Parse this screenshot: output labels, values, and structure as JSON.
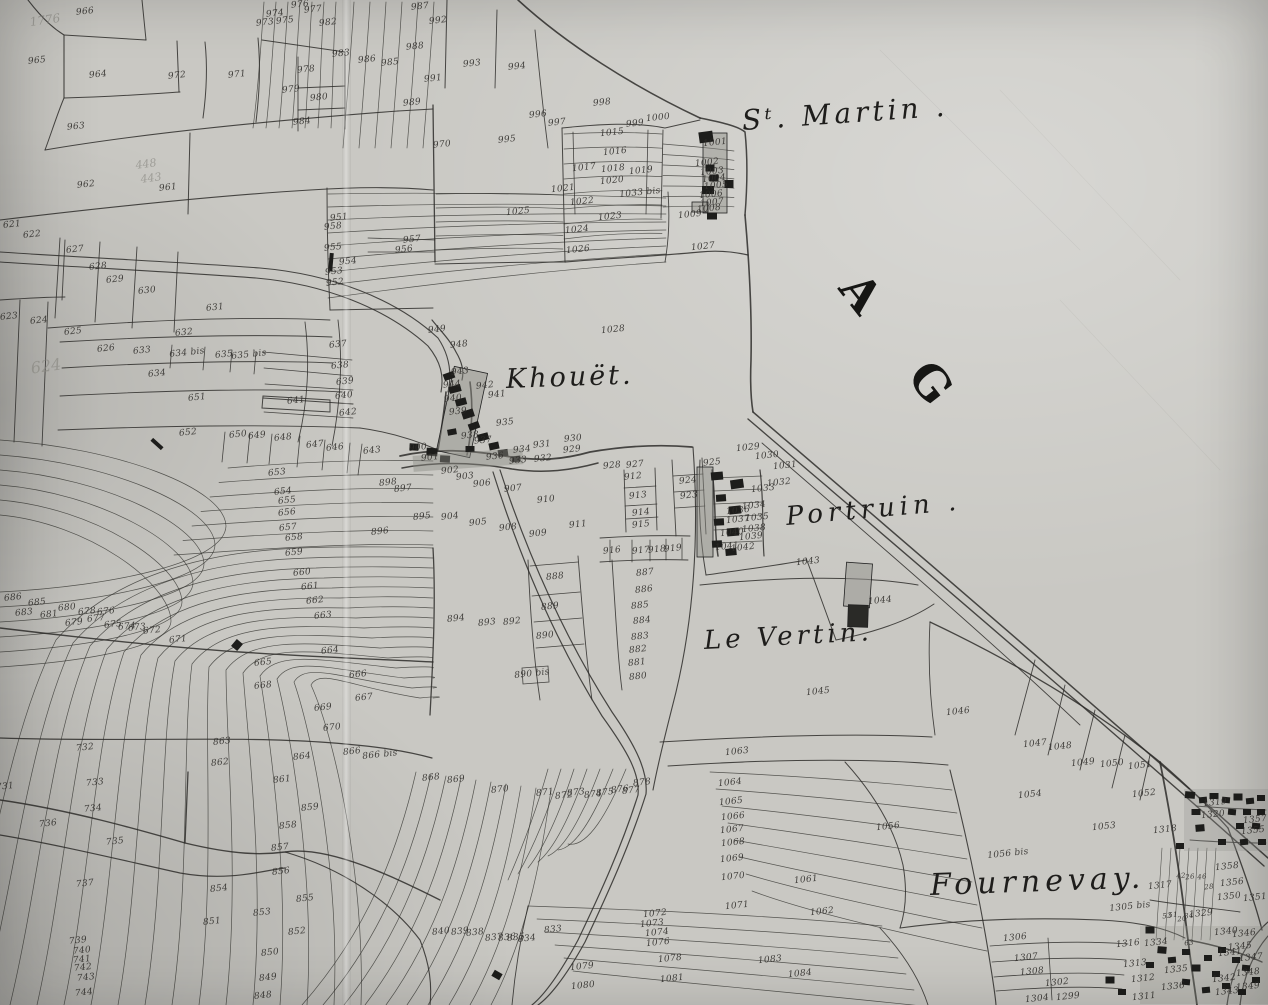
{
  "place_labels": {
    "st_martin": "Sᵗ. Martin .",
    "khouet": "Khouët.",
    "portruin": "Portruin .",
    "le_vertin": "Le Vertin.",
    "fournevay": "Fournevay.",
    "ag": "A G"
  },
  "faded_annotations": [
    {
      "text": "1776",
      "x": 45,
      "y": 20,
      "size": 12
    },
    {
      "text": "448",
      "x": 146,
      "y": 164,
      "size": 11
    },
    {
      "text": "443",
      "x": 151,
      "y": 178,
      "size": 11
    },
    {
      "text": "624",
      "x": 46,
      "y": 366,
      "size": 16
    }
  ],
  "parcel_numbers": [
    [
      "966",
      85,
      12
    ],
    [
      "965",
      37,
      61
    ],
    [
      "964",
      98,
      75
    ],
    [
      "972",
      177,
      76
    ],
    [
      "971",
      237,
      75
    ],
    [
      "963",
      76,
      127
    ],
    [
      "962",
      86,
      185
    ],
    [
      "961",
      168,
      188
    ],
    [
      "973",
      265,
      23
    ],
    [
      "974",
      275,
      14
    ],
    [
      "975",
      285,
      21
    ],
    [
      "976",
      300,
      5
    ],
    [
      "977",
      313,
      10
    ],
    [
      "982",
      328,
      23
    ],
    [
      "978",
      306,
      70
    ],
    [
      "979",
      291,
      90
    ],
    [
      "980",
      319,
      98
    ],
    [
      "984",
      302,
      122
    ],
    [
      "983",
      341,
      54
    ],
    [
      "987",
      420,
      7
    ],
    [
      "992",
      438,
      21
    ],
    [
      "988",
      415,
      47
    ],
    [
      "985",
      390,
      63
    ],
    [
      "986",
      367,
      60
    ],
    [
      "991",
      433,
      79
    ],
    [
      "989",
      412,
      103
    ],
    [
      "993",
      472,
      64
    ],
    [
      "994",
      517,
      67
    ],
    [
      "996",
      538,
      115
    ],
    [
      "997",
      557,
      123
    ],
    [
      "995",
      507,
      140
    ],
    [
      "970",
      442,
      145
    ],
    [
      "998",
      602,
      103
    ],
    [
      "999",
      635,
      124
    ],
    [
      "1000",
      658,
      118
    ],
    [
      "1001",
      715,
      143
    ],
    [
      "1015",
      612,
      133
    ],
    [
      "1016",
      615,
      152
    ],
    [
      "1017",
      584,
      168
    ],
    [
      "1018",
      613,
      169
    ],
    [
      "1019",
      641,
      171
    ],
    [
      "1020",
      612,
      181
    ],
    [
      "1021",
      563,
      189
    ],
    [
      "1022",
      582,
      202
    ],
    [
      "1033 bis",
      640,
      193
    ],
    [
      "1023",
      610,
      217
    ],
    [
      "1024",
      577,
      230
    ],
    [
      "1025",
      518,
      212
    ],
    [
      "1026",
      578,
      250
    ],
    [
      "1002",
      707,
      163
    ],
    [
      "1003",
      712,
      172
    ],
    [
      "1004",
      714,
      179
    ],
    [
      "1005",
      716,
      186
    ],
    [
      "1006",
      711,
      195
    ],
    [
      "1007",
      712,
      203
    ],
    [
      "1008",
      709,
      209
    ],
    [
      "1009",
      690,
      215
    ],
    [
      "1027",
      703,
      247
    ],
    [
      "1028",
      613,
      330
    ],
    [
      "951",
      339,
      218
    ],
    [
      "958",
      333,
      227
    ],
    [
      "957",
      412,
      240
    ],
    [
      "956",
      404,
      250
    ],
    [
      "955",
      333,
      248
    ],
    [
      "954",
      348,
      262
    ],
    [
      "953",
      334,
      272
    ],
    [
      "952",
      335,
      283
    ],
    [
      "949",
      437,
      330
    ],
    [
      "948",
      459,
      345
    ],
    [
      "943",
      460,
      372
    ],
    [
      "944",
      452,
      385
    ],
    [
      "942",
      485,
      386
    ],
    [
      "941",
      497,
      395
    ],
    [
      "940",
      453,
      399
    ],
    [
      "939",
      458,
      412
    ],
    [
      "938",
      470,
      436
    ],
    [
      "937",
      483,
      441
    ],
    [
      "936",
      495,
      457
    ],
    [
      "935",
      505,
      423
    ],
    [
      "934",
      522,
      450
    ],
    [
      "933",
      518,
      461
    ],
    [
      "932",
      543,
      459
    ],
    [
      "931",
      542,
      445
    ],
    [
      "930",
      573,
      439
    ],
    [
      "929",
      572,
      450
    ],
    [
      "928",
      612,
      466
    ],
    [
      "927",
      635,
      465
    ],
    [
      "924",
      688,
      481
    ],
    [
      "923",
      689,
      496
    ],
    [
      "925",
      712,
      463
    ],
    [
      "912",
      633,
      477
    ],
    [
      "913",
      638,
      496
    ],
    [
      "914",
      641,
      513
    ],
    [
      "915",
      641,
      525
    ],
    [
      "916",
      612,
      551
    ],
    [
      "917",
      641,
      551
    ],
    [
      "918",
      657,
      550
    ],
    [
      "919",
      673,
      549
    ],
    [
      "900",
      418,
      448
    ],
    [
      "901",
      430,
      458
    ],
    [
      "902",
      450,
      471
    ],
    [
      "903",
      465,
      477
    ],
    [
      "906",
      482,
      484
    ],
    [
      "907",
      513,
      489
    ],
    [
      "898",
      388,
      483
    ],
    [
      "897",
      403,
      489
    ],
    [
      "895",
      422,
      517
    ],
    [
      "904",
      450,
      517
    ],
    [
      "905",
      478,
      523
    ],
    [
      "896",
      380,
      532
    ],
    [
      "908",
      508,
      528
    ],
    [
      "909",
      538,
      534
    ],
    [
      "910",
      546,
      500
    ],
    [
      "911",
      578,
      525
    ],
    [
      "894",
      456,
      619
    ],
    [
      "893",
      487,
      623
    ],
    [
      "892",
      512,
      622
    ],
    [
      "890",
      545,
      636
    ],
    [
      "889",
      550,
      607
    ],
    [
      "888",
      555,
      577
    ],
    [
      "890 bis",
      532,
      674
    ],
    [
      "887",
      645,
      573
    ],
    [
      "886",
      644,
      590
    ],
    [
      "885",
      640,
      606
    ],
    [
      "884",
      642,
      621
    ],
    [
      "883",
      640,
      637
    ],
    [
      "882",
      638,
      650
    ],
    [
      "881",
      637,
      663
    ],
    [
      "880",
      638,
      677
    ],
    [
      "1029",
      748,
      448
    ],
    [
      "1030",
      767,
      456
    ],
    [
      "1031",
      785,
      466
    ],
    [
      "1032",
      779,
      483
    ],
    [
      "1033",
      763,
      489
    ],
    [
      "1034",
      754,
      506
    ],
    [
      "1036",
      738,
      511
    ],
    [
      "1035",
      757,
      518
    ],
    [
      "1037",
      738,
      520
    ],
    [
      "1038",
      754,
      529
    ],
    [
      "1040",
      732,
      533
    ],
    [
      "1039",
      751,
      537
    ],
    [
      "1041",
      727,
      547
    ],
    [
      "1042",
      743,
      548
    ],
    [
      "1043",
      808,
      562
    ],
    [
      "1044",
      880,
      601
    ],
    [
      "1045",
      818,
      692
    ],
    [
      "1046",
      958,
      712
    ],
    [
      "1047",
      1035,
      744
    ],
    [
      "1048",
      1060,
      747
    ],
    [
      "1049",
      1083,
      763
    ],
    [
      "1050",
      1112,
      764
    ],
    [
      "1051",
      1140,
      766
    ],
    [
      "1052",
      1144,
      794
    ],
    [
      "1053",
      1104,
      827
    ],
    [
      "1054",
      1030,
      795
    ],
    [
      "1056",
      888,
      827
    ],
    [
      "1056 bis",
      1008,
      854
    ],
    [
      "1063",
      737,
      752
    ],
    [
      "1061",
      806,
      880
    ],
    [
      "1062",
      822,
      912
    ],
    [
      "1064",
      730,
      783
    ],
    [
      "1065",
      731,
      802
    ],
    [
      "1066",
      733,
      817
    ],
    [
      "1067",
      732,
      830
    ],
    [
      "1068",
      733,
      843
    ],
    [
      "1069",
      732,
      859
    ],
    [
      "1070",
      733,
      877
    ],
    [
      "1071",
      737,
      906
    ],
    [
      "1072",
      655,
      914
    ],
    [
      "1073",
      652,
      924
    ],
    [
      "1074",
      657,
      933
    ],
    [
      "1076",
      658,
      943
    ],
    [
      "1078",
      670,
      959
    ],
    [
      "1079",
      582,
      967
    ],
    [
      "1081",
      672,
      979
    ],
    [
      "1080",
      583,
      986
    ],
    [
      "1083",
      770,
      960
    ],
    [
      "1084",
      800,
      974
    ],
    [
      "868",
      431,
      778
    ],
    [
      "869",
      456,
      780
    ],
    [
      "870",
      500,
      790
    ],
    [
      "871",
      545,
      793
    ],
    [
      "872",
      564,
      796
    ],
    [
      "873",
      576,
      793
    ],
    [
      "874",
      593,
      795
    ],
    [
      "875",
      605,
      793
    ],
    [
      "876",
      620,
      790
    ],
    [
      "877",
      631,
      791
    ],
    [
      "878",
      642,
      783
    ],
    [
      "833",
      553,
      930
    ],
    [
      "840",
      441,
      932
    ],
    [
      "839",
      460,
      932
    ],
    [
      "838",
      475,
      933
    ],
    [
      "837",
      494,
      938
    ],
    [
      "836",
      507,
      938
    ],
    [
      "835",
      516,
      938
    ],
    [
      "834",
      527,
      939
    ],
    [
      "866",
      352,
      752
    ],
    [
      "866 bis",
      380,
      755
    ],
    [
      "621",
      12,
      225
    ],
    [
      "622",
      32,
      235
    ],
    [
      "627",
      75,
      250
    ],
    [
      "628",
      98,
      267
    ],
    [
      "629",
      115,
      280
    ],
    [
      "630",
      147,
      291
    ],
    [
      "631",
      215,
      308
    ],
    [
      "623",
      9,
      317
    ],
    [
      "624",
      39,
      321
    ],
    [
      "625",
      73,
      332
    ],
    [
      "626",
      106,
      349
    ],
    [
      "632",
      184,
      333
    ],
    [
      "633",
      142,
      351
    ],
    [
      "634 bis",
      187,
      353
    ],
    [
      "635",
      224,
      355
    ],
    [
      "635 bis",
      249,
      355
    ],
    [
      "634",
      157,
      374
    ],
    [
      "651",
      197,
      398
    ],
    [
      "652",
      188,
      433
    ],
    [
      "650",
      238,
      435
    ],
    [
      "649",
      257,
      436
    ],
    [
      "648",
      283,
      438
    ],
    [
      "647",
      315,
      445
    ],
    [
      "646",
      335,
      448
    ],
    [
      "643",
      372,
      451
    ],
    [
      "637",
      338,
      345
    ],
    [
      "638",
      340,
      366
    ],
    [
      "639",
      345,
      382
    ],
    [
      "640",
      344,
      396
    ],
    [
      "641",
      296,
      401
    ],
    [
      "642",
      348,
      413
    ],
    [
      "653",
      277,
      473
    ],
    [
      "654",
      283,
      492
    ],
    [
      "655",
      287,
      501
    ],
    [
      "656",
      287,
      513
    ],
    [
      "657",
      288,
      528
    ],
    [
      "658",
      294,
      538
    ],
    [
      "659",
      294,
      553
    ],
    [
      "660",
      302,
      573
    ],
    [
      "661",
      310,
      587
    ],
    [
      "662",
      315,
      601
    ],
    [
      "663",
      323,
      616
    ],
    [
      "664",
      330,
      651
    ],
    [
      "665",
      263,
      663
    ],
    [
      "666",
      358,
      675
    ],
    [
      "667",
      364,
      698
    ],
    [
      "668",
      263,
      686
    ],
    [
      "669",
      323,
      708
    ],
    [
      "670",
      332,
      728
    ],
    [
      "686",
      13,
      598
    ],
    [
      "685",
      37,
      603
    ],
    [
      "683",
      24,
      613
    ],
    [
      "681",
      49,
      615
    ],
    [
      "680",
      67,
      608
    ],
    [
      "679",
      74,
      623
    ],
    [
      "678",
      87,
      612
    ],
    [
      "677",
      96,
      619
    ],
    [
      "676",
      106,
      612
    ],
    [
      "675",
      113,
      625
    ],
    [
      "674",
      127,
      627
    ],
    [
      "673",
      137,
      628
    ],
    [
      "672",
      152,
      631
    ],
    [
      "671",
      178,
      640
    ],
    [
      "731",
      5,
      787
    ],
    [
      "732",
      85,
      748
    ],
    [
      "733",
      95,
      783
    ],
    [
      "734",
      93,
      809
    ],
    [
      "736",
      48,
      824
    ],
    [
      "735",
      115,
      842
    ],
    [
      "737",
      85,
      884
    ],
    [
      "739",
      78,
      941
    ],
    [
      "740",
      82,
      951
    ],
    [
      "741",
      82,
      960
    ],
    [
      "742",
      83,
      968
    ],
    [
      "743",
      86,
      978
    ],
    [
      "744",
      84,
      993
    ],
    [
      "863",
      222,
      742
    ],
    [
      "862",
      220,
      763
    ],
    [
      "864",
      302,
      757
    ],
    [
      "861",
      282,
      780
    ],
    [
      "859",
      310,
      808
    ],
    [
      "858",
      288,
      826
    ],
    [
      "857",
      280,
      848
    ],
    [
      "856",
      281,
      872
    ],
    [
      "854",
      219,
      889
    ],
    [
      "855",
      305,
      899
    ],
    [
      "853",
      262,
      913
    ],
    [
      "851",
      212,
      922
    ],
    [
      "852",
      297,
      932
    ],
    [
      "850",
      270,
      953
    ],
    [
      "849",
      268,
      978
    ],
    [
      "848",
      263,
      996
    ],
    [
      "1319",
      1215,
      803
    ],
    [
      "1320",
      1213,
      815
    ],
    [
      "1318",
      1165,
      830
    ],
    [
      "1317",
      1160,
      886
    ],
    [
      "1357",
      1255,
      820
    ],
    [
      "1355",
      1253,
      831
    ],
    [
      "1358",
      1227,
      867
    ],
    [
      "1356",
      1232,
      883
    ],
    [
      "1350",
      1229,
      897
    ],
    [
      "1351",
      1255,
      898
    ],
    [
      "1329",
      1201,
      914
    ],
    [
      "1334",
      1156,
      943
    ],
    [
      "1335",
      1176,
      970
    ],
    [
      "1336",
      1173,
      987
    ],
    [
      "1311",
      1144,
      997
    ],
    [
      "1313",
      1135,
      964
    ],
    [
      "1312",
      1143,
      979
    ],
    [
      "1316",
      1128,
      944
    ],
    [
      "1305 bis",
      1130,
      907
    ],
    [
      "1306",
      1015,
      938
    ],
    [
      "1307",
      1026,
      958
    ],
    [
      "1308",
      1032,
      972
    ],
    [
      "1302",
      1057,
      983
    ],
    [
      "1299",
      1068,
      997
    ],
    [
      "1304",
      1037,
      999
    ],
    [
      "1346",
      1244,
      934
    ],
    [
      "1340",
      1226,
      932
    ],
    [
      "1341",
      1230,
      953
    ],
    [
      "1347",
      1251,
      958
    ],
    [
      "1348",
      1248,
      973
    ],
    [
      "1349",
      1248,
      987
    ],
    [
      "1342",
      1224,
      979
    ],
    [
      "1343",
      1227,
      992
    ],
    [
      "1345",
      1240,
      947
    ],
    [
      "42",
      1181,
      876,
      0,
      7
    ],
    [
      "26",
      1190,
      877,
      0,
      7
    ],
    [
      "46",
      1202,
      877,
      0,
      7
    ],
    [
      "28",
      1209,
      887,
      0,
      7
    ],
    [
      "51",
      1173,
      915,
      0,
      7
    ],
    [
      "53",
      1167,
      916,
      0,
      7
    ],
    [
      "34",
      1189,
      916,
      0,
      7
    ],
    [
      "20",
      1182,
      919,
      0,
      7
    ],
    [
      "63",
      1189,
      943,
      0,
      7
    ]
  ]
}
